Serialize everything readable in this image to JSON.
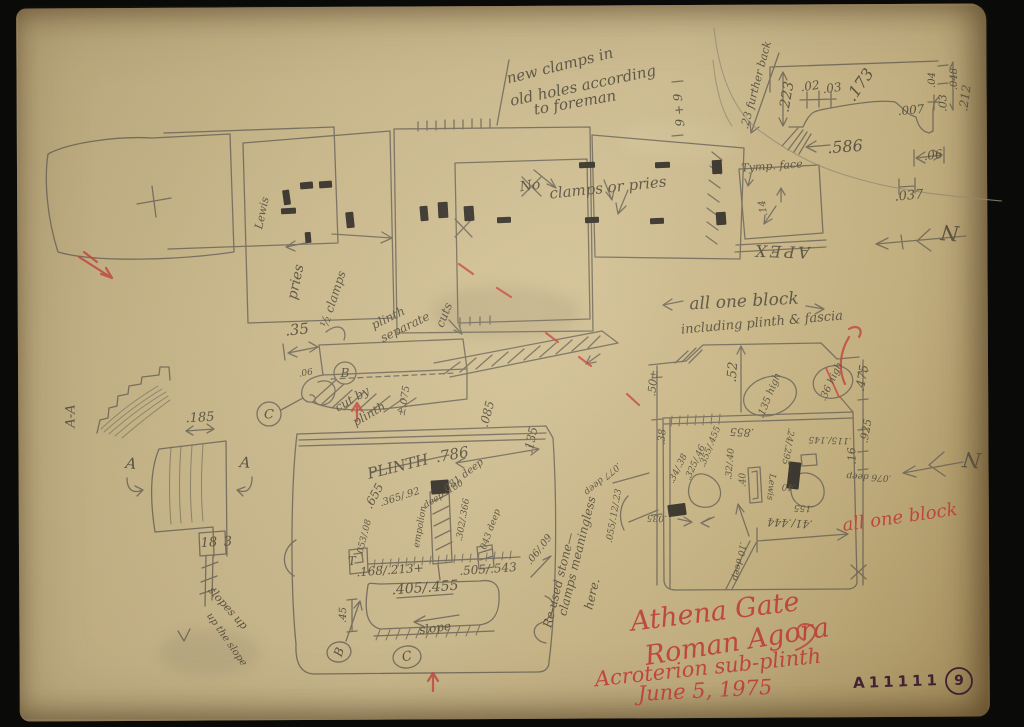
{
  "colors": {
    "paper": "#cdbb8e",
    "pencil": "#57513f",
    "red": "#c6443e",
    "ink": "#3f2034",
    "background": "#0a0a08"
  },
  "sheet": {
    "number": "A11111",
    "page": "9"
  },
  "red_inscription": [
    "Athena Gate",
    "Roman Agora",
    "Acroterion sub-plinth",
    "June 5, 1975",
    "all one block"
  ],
  "annotations": [
    {
      "t": "new clamps in",
      "x": 560,
      "y": 66,
      "r": -14,
      "s": 15,
      "n": "note-new-clamps"
    },
    {
      "t": "old holes according",
      "x": 583,
      "y": 86,
      "r": -12,
      "s": 15,
      "n": "note-new-clamps"
    },
    {
      "t": "to foreman",
      "x": 575,
      "y": 103,
      "r": -10,
      "s": 15,
      "n": "note-new-clamps"
    },
    {
      "t": "9 + 9",
      "x": 679,
      "y": 110,
      "r": -95,
      "s": 12
    },
    {
      "t": ".23 further back",
      "x": 756,
      "y": 85,
      "r": -75,
      "s": 11
    },
    {
      "t": ".223",
      "x": 787,
      "y": 97,
      "r": -80,
      "s": 14
    },
    {
      "t": ".02",
      "x": 810,
      "y": 86,
      "r": -8,
      "s": 12
    },
    {
      "t": ".03",
      "x": 832,
      "y": 88,
      "r": -8,
      "s": 12
    },
    {
      "t": ".173",
      "x": 860,
      "y": 85,
      "r": -55,
      "s": 16
    },
    {
      "t": ".04",
      "x": 933,
      "y": 80,
      "r": -90,
      "s": 10
    },
    {
      "t": ".048",
      "x": 955,
      "y": 79,
      "r": -90,
      "s": 10
    },
    {
      "t": ".03",
      "x": 943,
      "y": 103,
      "r": -90,
      "s": 11
    },
    {
      "t": ".212",
      "x": 965,
      "y": 98,
      "r": -82,
      "s": 12
    },
    {
      "t": ".007",
      "x": 911,
      "y": 110,
      "r": -5,
      "s": 12
    },
    {
      "t": ".586",
      "x": 845,
      "y": 147,
      "r": -4,
      "s": 16
    },
    {
      "t": ".06",
      "x": 933,
      "y": 155,
      "r": -8,
      "s": 12
    },
    {
      "t": ".037",
      "x": 909,
      "y": 196,
      "r": -5,
      "s": 13
    },
    {
      "t": "Tymp. face",
      "x": 772,
      "y": 166,
      "r": -4,
      "s": 11
    },
    {
      "t": "APEX",
      "x": 781,
      "y": 251,
      "r": 182,
      "s": 16,
      "ls": 3
    },
    {
      "t": ".14",
      "x": 764,
      "y": 208,
      "r": -100,
      "s": 10
    },
    {
      "t": "N",
      "x": 950,
      "y": 232,
      "r": 185,
      "s": 21,
      "n": "north-arrow-label"
    },
    {
      "t": "Lewis",
      "x": 262,
      "y": 213,
      "r": -78,
      "s": 11
    },
    {
      "t": "No",
      "x": 530,
      "y": 186,
      "r": -8,
      "s": 14
    },
    {
      "t": "clamps or pries",
      "x": 608,
      "y": 188,
      "r": -6,
      "s": 15,
      "n": "note-clamps-or-pries"
    },
    {
      "t": "pries",
      "x": 296,
      "y": 282,
      "r": -78,
      "s": 14
    },
    {
      "t": "½ clamps",
      "x": 333,
      "y": 299,
      "r": -72,
      "s": 12
    },
    {
      "t": ".35",
      "x": 297,
      "y": 330,
      "r": -6,
      "s": 15
    },
    {
      "t": "plinth",
      "x": 388,
      "y": 318,
      "r": -26,
      "s": 12
    },
    {
      "t": "separate",
      "x": 405,
      "y": 327,
      "r": -26,
      "s": 12
    },
    {
      "t": "cuts",
      "x": 444,
      "y": 315,
      "r": -68,
      "s": 12
    },
    {
      "t": "B",
      "x": 345,
      "y": 373,
      "r": 0,
      "s": 12,
      "n": "circled-b-label"
    },
    {
      "t": "C",
      "x": 269,
      "y": 415,
      "r": 0,
      "s": 13,
      "n": "circled-c-label"
    },
    {
      "t": "cut by",
      "x": 352,
      "y": 399,
      "r": -30,
      "s": 12
    },
    {
      "t": "plinth",
      "x": 369,
      "y": 414,
      "r": -30,
      "s": 12
    },
    {
      "t": "±.075",
      "x": 405,
      "y": 401,
      "r": -80,
      "s": 10
    },
    {
      "t": ".06",
      "x": 306,
      "y": 374,
      "r": -10,
      "s": 9
    },
    {
      "t": ".085",
      "x": 487,
      "y": 414,
      "r": -75,
      "s": 12
    },
    {
      "t": ".135",
      "x": 531,
      "y": 440,
      "r": -78,
      "s": 12
    },
    {
      "t": ".50±",
      "x": 653,
      "y": 383,
      "r": -84,
      "s": 11
    },
    {
      "t": ".52",
      "x": 733,
      "y": 372,
      "r": -86,
      "s": 13
    },
    {
      "t": "all one block",
      "x": 744,
      "y": 302,
      "r": -3,
      "s": 17,
      "n": "note-all-one-block"
    },
    {
      "t": "including plinth & fascia",
      "x": 762,
      "y": 323,
      "r": -5,
      "s": 13,
      "n": "note-all-one-block"
    },
    {
      "t": ".135 high",
      "x": 770,
      "y": 396,
      "r": -68,
      "s": 10
    },
    {
      "t": ".36 high",
      "x": 832,
      "y": 382,
      "r": -65,
      "s": 10
    },
    {
      "t": ".475",
      "x": 862,
      "y": 378,
      "r": -80,
      "s": 12
    },
    {
      "t": ".925",
      "x": 866,
      "y": 431,
      "r": -80,
      "s": 11
    },
    {
      "t": ".16",
      "x": 852,
      "y": 456,
      "r": -92,
      "s": 11
    },
    {
      "t": ".115/.145",
      "x": 830,
      "y": 439,
      "r": 182,
      "s": 9
    },
    {
      "t": ".855",
      "x": 742,
      "y": 432,
      "r": 183,
      "s": 11
    },
    {
      "t": ".32/.40",
      "x": 731,
      "y": 464,
      "r": -85,
      "s": 9
    },
    {
      "t": ".355/.455",
      "x": 711,
      "y": 447,
      "r": -68,
      "s": 9
    },
    {
      "t": ".325/.46",
      "x": 696,
      "y": 463,
      "r": -66,
      "s": 9
    },
    {
      "t": ".34/.38",
      "x": 679,
      "y": 469,
      "r": -64,
      "s": 9
    },
    {
      "t": ".38",
      "x": 663,
      "y": 437,
      "r": -86,
      "s": 10
    },
    {
      "t": ".24/.295",
      "x": 787,
      "y": 446,
      "r": 100,
      "s": 9
    },
    {
      "t": ".40",
      "x": 789,
      "y": 486,
      "r": 183,
      "s": 9
    },
    {
      "t": ".40",
      "x": 744,
      "y": 480,
      "r": -90,
      "s": 9
    },
    {
      "t": "Lewis",
      "x": 770,
      "y": 487,
      "r": 96,
      "s": 9
    },
    {
      "t": ".155",
      "x": 804,
      "y": 507,
      "r": 183,
      "s": 9
    },
    {
      "t": ".41/.444",
      "x": 790,
      "y": 523,
      "r": 183,
      "s": 11
    },
    {
      "t": ".10 deep",
      "x": 738,
      "y": 561,
      "r": 102,
      "s": 9
    },
    {
      "t": ".035",
      "x": 657,
      "y": 517,
      "r": 183,
      "s": 9
    },
    {
      "t": ".076 deep",
      "x": 869,
      "y": 476,
      "r": 183,
      "s": 9
    },
    {
      "t": "N",
      "x": 972,
      "y": 459,
      "r": 185,
      "s": 21,
      "n": "north-arrow-label"
    },
    {
      "t": ".055/.12/.23",
      "x": 615,
      "y": 516,
      "r": -80,
      "s": 9
    },
    {
      "t": ".077 deep",
      "x": 602,
      "y": 478,
      "r": 140,
      "s": 9
    },
    {
      "t": "Re-used stone—",
      "x": 559,
      "y": 580,
      "r": -76,
      "s": 12,
      "n": "note-reused-stone"
    },
    {
      "t": "clamps meaningless",
      "x": 577,
      "y": 556,
      "r": -76,
      "s": 12,
      "n": "note-reused-stone"
    },
    {
      "t": "here.",
      "x": 592,
      "y": 594,
      "r": -76,
      "s": 12,
      "n": "note-reused-stone"
    },
    {
      "t": ".06/.09",
      "x": 540,
      "y": 550,
      "r": -52,
      "s": 10
    },
    {
      "t": "PLINTH",
      "x": 398,
      "y": 467,
      "r": -14,
      "s": 15
    },
    {
      "t": ".786",
      "x": 452,
      "y": 455,
      "r": -10,
      "s": 15
    },
    {
      "t": ".655",
      "x": 374,
      "y": 496,
      "r": -62,
      "s": 12
    },
    {
      "t": ".365/.92",
      "x": 400,
      "y": 498,
      "r": -18,
      "s": 10
    },
    {
      "t": ".081 deep",
      "x": 463,
      "y": 477,
      "r": -38,
      "s": 10
    },
    {
      "t": "deep .180",
      "x": 444,
      "y": 495,
      "r": -32,
      "s": 9
    },
    {
      "t": "empolion",
      "x": 421,
      "y": 527,
      "r": -80,
      "s": 9
    },
    {
      "t": ".302/.366",
      "x": 464,
      "y": 520,
      "r": -80,
      "s": 9
    },
    {
      "t": ".043 deep",
      "x": 491,
      "y": 531,
      "r": -70,
      "s": 9
    },
    {
      "t": ".053/.08",
      "x": 365,
      "y": 538,
      "r": -76,
      "s": 9
    },
    {
      "t": ".168/.213+",
      "x": 390,
      "y": 570,
      "r": -4,
      "s": 12
    },
    {
      "t": ".505/.543",
      "x": 488,
      "y": 569,
      "r": -4,
      "s": 12
    },
    {
      "t": ".405/.455",
      "x": 425,
      "y": 588,
      "r": -4,
      "s": 14
    },
    {
      "t": "slope",
      "x": 435,
      "y": 628,
      "r": -8,
      "s": 12
    },
    {
      "t": "B",
      "x": 339,
      "y": 652,
      "r": -70,
      "s": 12,
      "n": "circled-b-label"
    },
    {
      "t": "C",
      "x": 407,
      "y": 657,
      "r": -12,
      "s": 13,
      "n": "circled-c-label"
    },
    {
      "t": ".45",
      "x": 344,
      "y": 615,
      "r": -88,
      "s": 10
    },
    {
      "t": "T",
      "x": 352,
      "y": 561,
      "r": -5,
      "s": 12
    },
    {
      "t": ".185",
      "x": 200,
      "y": 418,
      "r": -3,
      "s": 13
    },
    {
      "t": "A-A",
      "x": 71,
      "y": 416,
      "r": -90,
      "s": 13,
      "n": "section-label-aa"
    },
    {
      "t": "A",
      "x": 131,
      "y": 464,
      "r": 6,
      "s": 15,
      "n": "section-marker-a"
    },
    {
      "t": "A",
      "x": 245,
      "y": 463,
      "r": 4,
      "s": 15,
      "n": "section-marker-a"
    },
    {
      "t": "18",
      "x": 209,
      "y": 543,
      "r": -4,
      "s": 13
    },
    {
      "t": "3",
      "x": 228,
      "y": 542,
      "r": -4,
      "s": 13
    },
    {
      "t": "slopes up",
      "x": 228,
      "y": 608,
      "r": 48,
      "s": 11
    },
    {
      "t": "up the slope",
      "x": 226,
      "y": 640,
      "r": 55,
      "s": 10
    }
  ]
}
